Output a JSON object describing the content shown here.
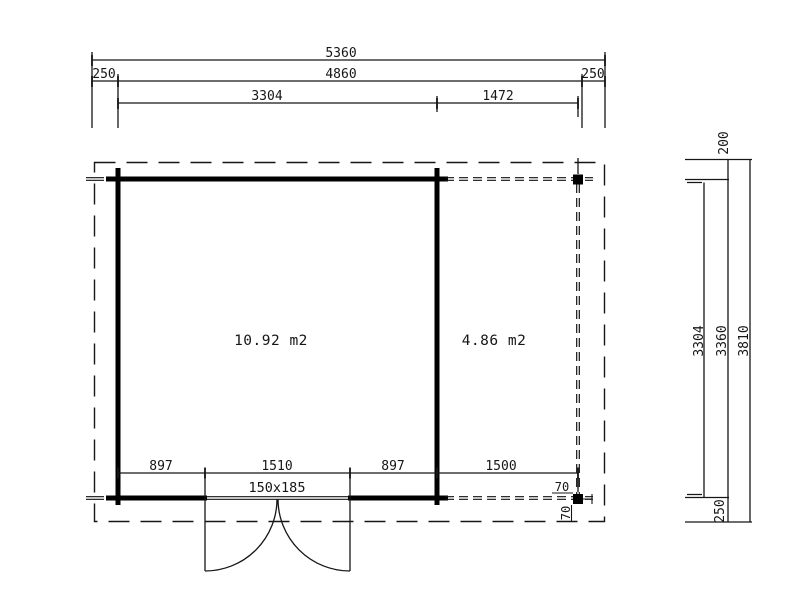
{
  "colors": {
    "line": "#161616",
    "wall": "#000000",
    "background": "#ffffff"
  },
  "dims": {
    "top": {
      "total_width": "5360",
      "overhang_left": "250",
      "body_width": "4860",
      "overhang_right": "250",
      "room_width": "3304",
      "terrace_width": "1472"
    },
    "bottom": {
      "wall_to_door": "897",
      "door_opening": "1510",
      "door_to_wall": "897",
      "terrace_width": "1500",
      "post_offset_h": "70",
      "post_offset_v": "70"
    },
    "right": {
      "overhang_top": "200",
      "inner_depth": "3304",
      "outer_depth": "3360",
      "total_depth": "3810",
      "overhang_bottom": "250"
    }
  },
  "labels": {
    "main_room_area": "10.92 m2",
    "terrace_area": "4.86 m2",
    "door_size": "150x185"
  }
}
